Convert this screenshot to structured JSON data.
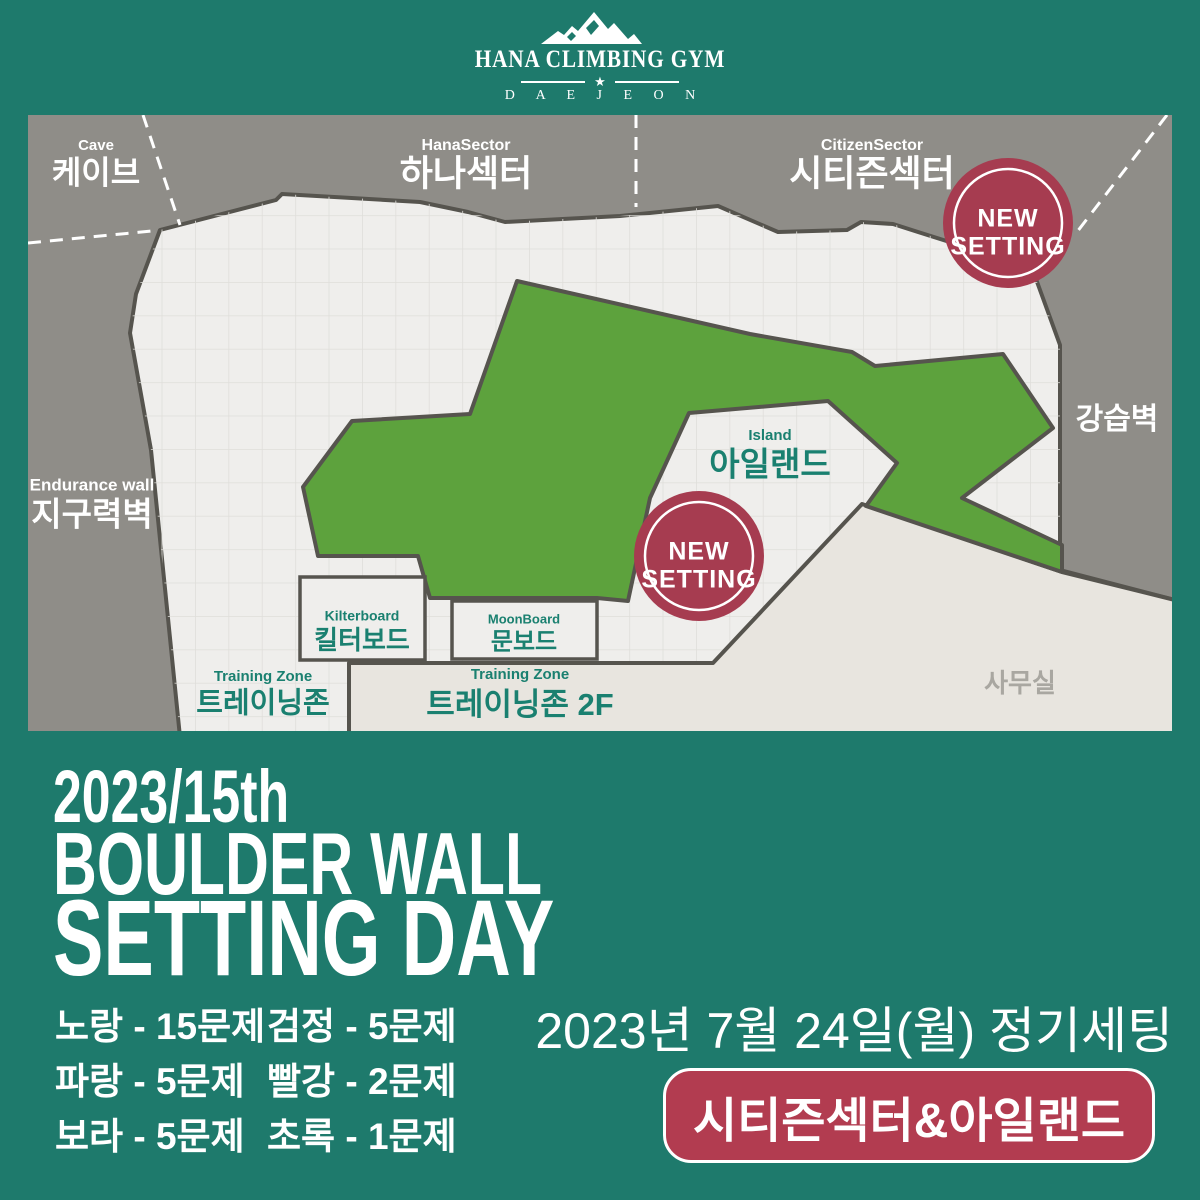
{
  "brand": {
    "name": "HANA CLIMBING GYM",
    "star": "★",
    "city": "D A E J E O N"
  },
  "map": {
    "sectors": {
      "cave": {
        "en": "Cave",
        "kr": "케이브"
      },
      "hana": {
        "en": "HanaSector",
        "kr": "하나섹터"
      },
      "citizen": {
        "en": "CitizenSector",
        "kr": "시티즌섹터"
      },
      "lecture": {
        "kr": "강습벽"
      },
      "endurance": {
        "en": "Endurance wall",
        "kr": "지구력벽"
      },
      "island": {
        "en": "Island",
        "kr": "아일랜드"
      },
      "kilter": {
        "en": "Kilterboard",
        "kr": "킬터보드"
      },
      "moon": {
        "en": "MoonBoard",
        "kr": "문보드"
      },
      "training": {
        "en": "Training Zone",
        "kr": "트레이닝존"
      },
      "training2f": {
        "en": "Training Zone",
        "kr": "트레이닝존 2F"
      },
      "office": {
        "kr": "사무실"
      }
    },
    "new_setting": {
      "line1": "NEW",
      "line2": "SETTING"
    }
  },
  "title": {
    "line1": "2023/15th",
    "line2": "BOULDER WALL",
    "line3": "SETTING DAY"
  },
  "problems": {
    "items": [
      "노랑 - 15문제",
      "검정 - 5문제",
      "파랑 - 5문제",
      "빨강 - 2문제",
      "보라 - 5문제",
      "초록 - 1문제"
    ]
  },
  "schedule": {
    "date": "2023년 7월 24일(월) 정기세팅",
    "target": "시티즌섹터&아일랜드"
  },
  "colors": {
    "background_teal": "#1e7a6c",
    "map_gray": "#8f8d88",
    "floor_light": "#efeeec",
    "floor_beige": "#e8e5df",
    "green_zone": "#5da23d",
    "outline_dark": "#56544e",
    "new_setting_red": "#a63c50",
    "target_badge_red": "#b23c50",
    "label_teal": "#1a8070",
    "office_label_gray": "#a9a7a1"
  }
}
